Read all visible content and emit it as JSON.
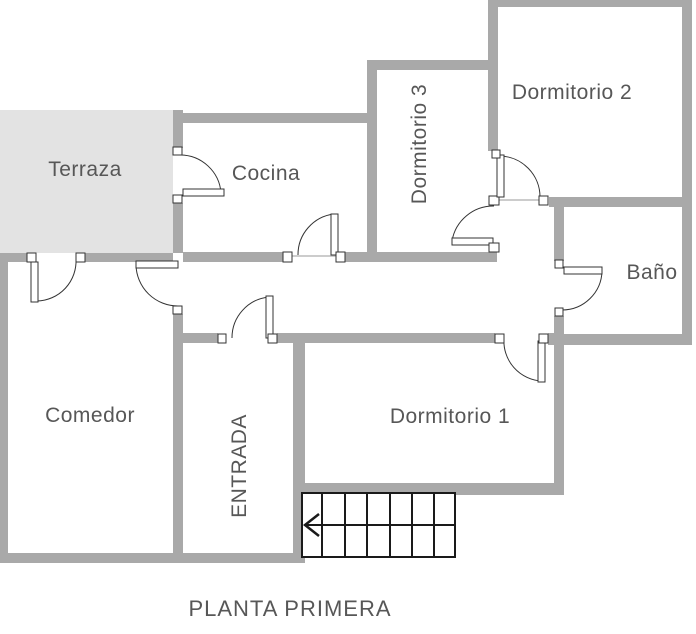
{
  "title": "PLANTA PRIMERA",
  "rooms": {
    "terraza": {
      "label": "Terraza"
    },
    "cocina": {
      "label": "Cocina"
    },
    "dormitorio3": {
      "label": "Dormitorio 3"
    },
    "dormitorio2": {
      "label": "Dormitorio 2"
    },
    "bano": {
      "label": "Baño"
    },
    "comedor": {
      "label": "Comedor"
    },
    "entrada": {
      "label": "ENTRADA"
    },
    "dormitorio1": {
      "label": "Dormitorio 1"
    }
  },
  "icons": {
    "stairs_direction": "left-arrow"
  },
  "colors": {
    "wall": "#a9a9a9",
    "terrace_fill": "#e3e3e3",
    "label_text": "#575757",
    "stairs_line": "#1a1a1a",
    "door_line": "#333333"
  }
}
